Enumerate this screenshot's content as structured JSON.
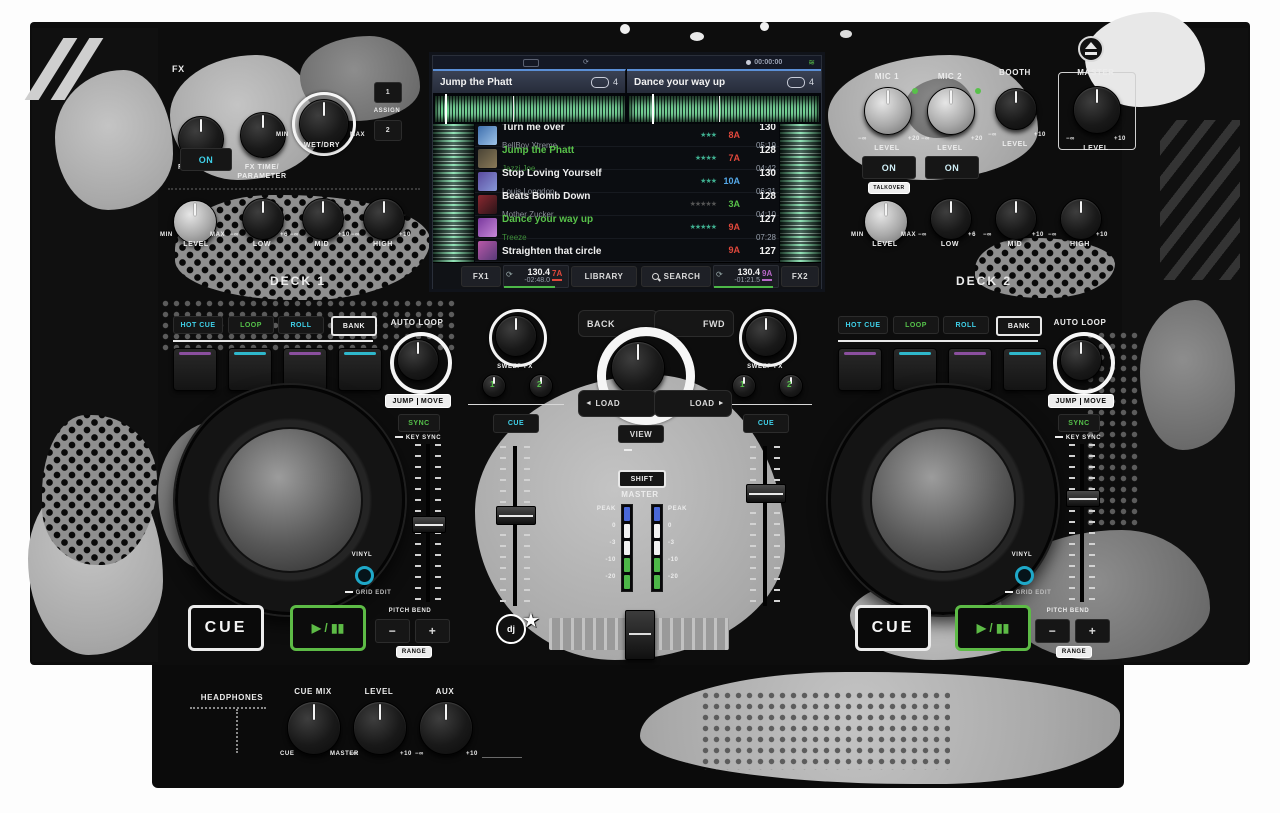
{
  "colors": {
    "accent_cyan": "#3fd0e8",
    "accent_green": "#55c14a",
    "pad_purple": "#8a4f9e",
    "pad_cyan": "#2fb8cc",
    "key_red": "#e0483c",
    "key_blue": "#54a8e8",
    "key_green": "#58c14a",
    "key_magenta": "#b868c8",
    "screen_header_blue": "#5b8fd6",
    "vu_blue": "#4a68d8",
    "vu_green": "#4db848"
  },
  "screen": {
    "status": {
      "record_time": "00:00:00"
    },
    "deck_a": {
      "title": "Jump the Phatt",
      "loop_len": "4"
    },
    "deck_b": {
      "title": "Dance your way up",
      "loop_len": "4"
    },
    "tracks": [
      {
        "title": "Turn me over",
        "artist": "BellBoy Xtreme",
        "key": "8A",
        "bpm": "130",
        "time": "05:19",
        "stars": "★★★"
      },
      {
        "title": "Jump the Phatt",
        "artist": "Jazzi Joe",
        "key": "7A",
        "bpm": "128",
        "time": "04:42",
        "stars": "★★★★"
      },
      {
        "title": "Stop Loving Yourself",
        "artist": "Louis Longdon",
        "key": "10A",
        "bpm": "130",
        "time": "06:31",
        "stars": "★★★"
      },
      {
        "title": "Beats Bomb Down",
        "artist": "Mother Zucker",
        "key": "3A",
        "bpm": "128",
        "time": "04:10",
        "stars": "★★★★★"
      },
      {
        "title": "Dance your way up",
        "artist": "Treeze",
        "key": "9A",
        "bpm": "127",
        "time": "07:28",
        "stars": "★★★★★"
      },
      {
        "title": "Straighten that circle",
        "artist": "",
        "key": "9A",
        "bpm": "127",
        "time": "",
        "stars": ""
      }
    ],
    "footer": {
      "fx1": "FX1",
      "fx2": "FX2",
      "library": "LIBRARY",
      "search": "SEARCH",
      "deck1_bpm": "130.4",
      "deck1_remain": "-02:48.0",
      "deck1_key": "7A",
      "deck2_bpm": "130.4",
      "deck2_remain": "-01:21.5",
      "deck2_key": "9A"
    }
  },
  "fx": {
    "title": "FX",
    "select": "FX SELECT",
    "time": "FX TIME/",
    "param": "PARAMETER",
    "min": "MIN",
    "max": "MAX",
    "wetdry": "WET/DRY",
    "assign": "ASSIGN",
    "a1": "1",
    "a2": "2",
    "on": "ON"
  },
  "eq": {
    "level": "LEVEL",
    "low": "LOW",
    "mid": "MID",
    "high": "HIGH",
    "min": "MIN",
    "max": "MAX",
    "ninf": "−∞",
    "p6": "+6",
    "p10": "+10"
  },
  "deck1_name": "DECK 1",
  "deck2_name": "DECK 2",
  "mic": {
    "mic1": "MIC 1",
    "mic2": "MIC 2",
    "level": "LEVEL",
    "ninf": "−∞",
    "p20": "+20",
    "p10": "+10",
    "on": "ON",
    "talkover": "TALKOVER",
    "booth": "BOOTH",
    "master": "MASTER"
  },
  "perf": {
    "hot_cue": "HOT CUE",
    "loop": "LOOP",
    "roll": "ROLL",
    "bank": "BANK",
    "auto_loop": "AUTO LOOP",
    "jump": "JUMP",
    "move": "MOVE",
    "sync": "SYNC",
    "key_sync": "KEY SYNC",
    "vinyl": "VINYL",
    "grid_edit": "GRID EDIT",
    "cue": "CUE",
    "play": "▶ / ▮▮",
    "pitch_bend": "PITCH BEND",
    "minus": "−",
    "plus": "+",
    "range": "RANGE"
  },
  "mixer": {
    "sweep_fx": "SWEEP FX",
    "b1": "1",
    "b2": "2",
    "cue": "CUE",
    "back": "BACK",
    "fwd": "FWD",
    "load": "LOAD",
    "al": "◄",
    "ar": "►",
    "view": "VIEW",
    "menu": "MENU",
    "shift": "SHIFT",
    "master": "MASTER",
    "peak": "PEAK",
    "vu": [
      "0",
      "-3",
      "-10",
      "-20"
    ],
    "dj_logo": "dj"
  },
  "front": {
    "headphones": "HEADPHONES",
    "cue_mix": "CUE MIX",
    "cue": "CUE",
    "master": "MASTER",
    "level": "LEVEL",
    "aux": "AUX",
    "ninf": "−∞",
    "p10": "+10"
  }
}
